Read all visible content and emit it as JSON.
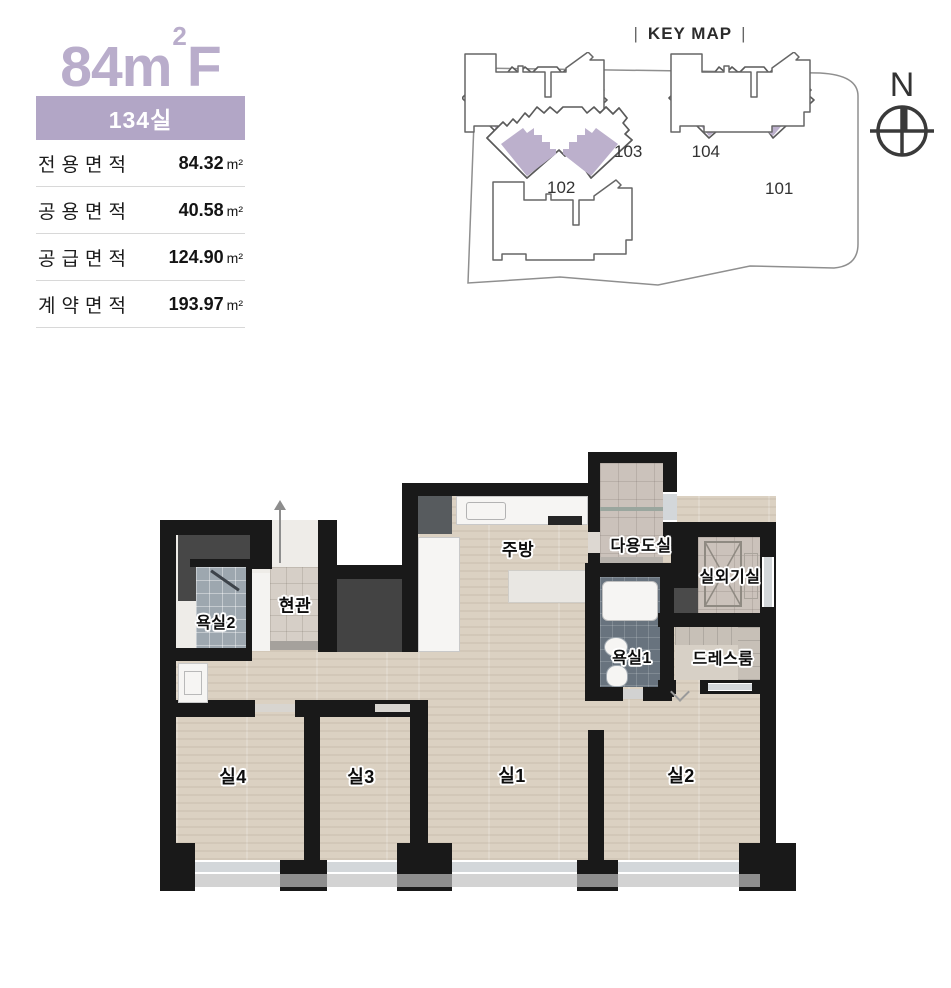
{
  "unit": {
    "title_base": "84m",
    "title_sup": "2",
    "title_suffix": "F",
    "badge": "134실",
    "specs": [
      {
        "label": "전용면적",
        "value": "84.32",
        "unit": "m²"
      },
      {
        "label": "공용면적",
        "value": "40.58",
        "unit": "m²"
      },
      {
        "label": "공급면적",
        "value": "124.90",
        "unit": "m²"
      },
      {
        "label": "계약면적",
        "value": "193.97",
        "unit": "m²"
      }
    ]
  },
  "keymap": {
    "bar": "|",
    "title": "KEY MAP",
    "compass": "N",
    "buildings": [
      {
        "id": "103",
        "highlighted": true
      },
      {
        "id": "104",
        "highlighted": true
      },
      {
        "id": "102",
        "highlighted": false
      },
      {
        "id": "101",
        "highlighted": false
      }
    ]
  },
  "floorplan": {
    "rooms": {
      "kitchen": "주방",
      "utility": "다용도실",
      "outdoor_unit": "실외기실",
      "bath2": "욕실2",
      "entrance": "현관",
      "bath1": "욕실1",
      "dressroom": "드레스룸",
      "room4": "실4",
      "room3": "실3",
      "room1": "실1",
      "room2": "실2"
    }
  },
  "colors": {
    "accent_purple": "#b9adcb",
    "badge_purple": "#b2a6c6",
    "keymap_highlight": "#bcb0cc",
    "wall": "#191919",
    "wood_floor": "#dbd1c2"
  }
}
